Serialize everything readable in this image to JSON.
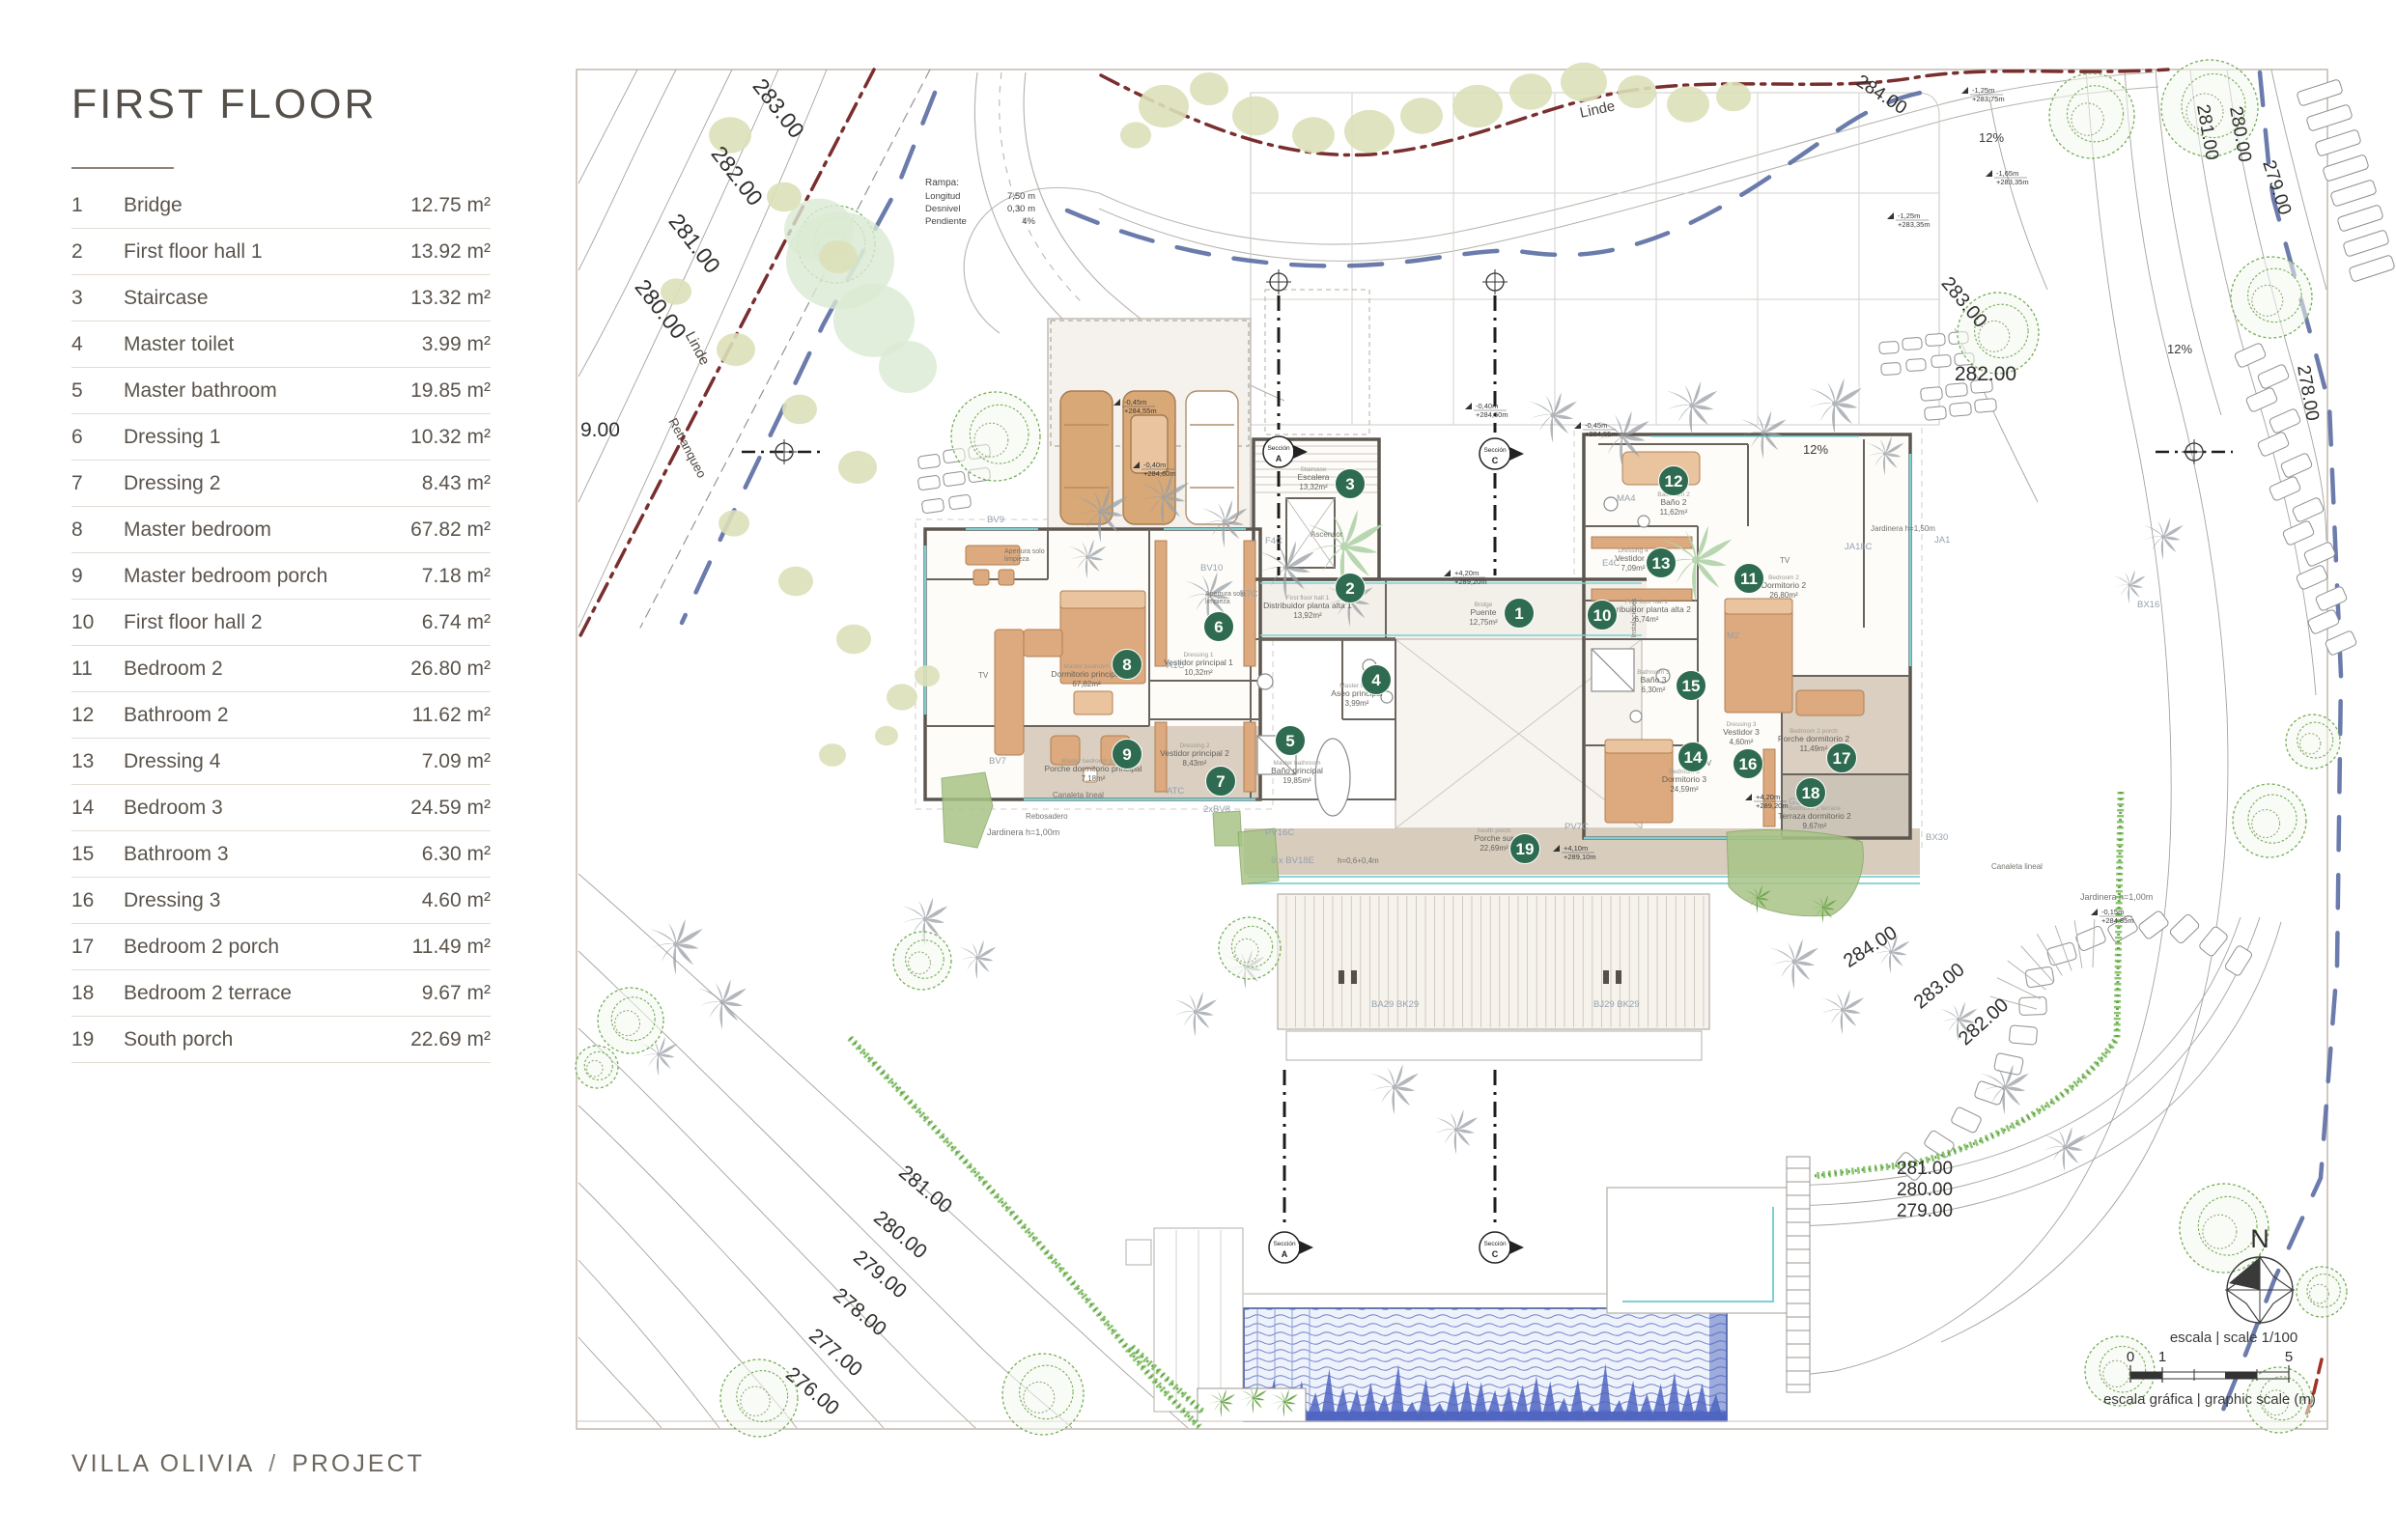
{
  "page": {
    "title": "FIRST FLOOR",
    "footer": {
      "project_name": "VILLA OLIVIA",
      "separator": "/",
      "project_label": "PROJECT"
    }
  },
  "legend": {
    "rows": [
      {
        "num": "1",
        "name": "Bridge",
        "area": "12.75 m²"
      },
      {
        "num": "2",
        "name": "First floor hall 1",
        "area": "13.92 m²"
      },
      {
        "num": "3",
        "name": "Staircase",
        "area": "13.32 m²"
      },
      {
        "num": "4",
        "name": "Master toilet",
        "area": "3.99 m²"
      },
      {
        "num": "5",
        "name": "Master bathroom",
        "area": "19.85 m²"
      },
      {
        "num": "6",
        "name": "Dressing 1",
        "area": "10.32 m²"
      },
      {
        "num": "7",
        "name": "Dressing 2",
        "area": "8.43 m²"
      },
      {
        "num": "8",
        "name": "Master bedroom",
        "area": "67.82 m²"
      },
      {
        "num": "9",
        "name": "Master bedroom porch",
        "area": "7.18 m²"
      },
      {
        "num": "10",
        "name": "First floor hall 2",
        "area": "6.74 m²"
      },
      {
        "num": "11",
        "name": "Bedroom 2",
        "area": "26.80 m²"
      },
      {
        "num": "12",
        "name": "Bathroom 2",
        "area": "11.62 m²"
      },
      {
        "num": "13",
        "name": "Dressing 4",
        "area": "7.09 m²"
      },
      {
        "num": "14",
        "name": "Bedroom 3",
        "area": "24.59 m²"
      },
      {
        "num": "15",
        "name": "Bathroom 3",
        "area": "6.30 m²"
      },
      {
        "num": "16",
        "name": "Dressing 3",
        "area": "4.60 m²"
      },
      {
        "num": "17",
        "name": "Bedroom 2 porch",
        "area": "11.49 m²"
      },
      {
        "num": "18",
        "name": "Bedroom 2 terrace",
        "area": "9.67 m²"
      },
      {
        "num": "19",
        "name": "South porch",
        "area": "22.69 m²"
      }
    ]
  },
  "plan": {
    "colors": {
      "badge": "#2e6b50",
      "boundary": "#7a2e2e",
      "setback_blue": "#5a6da3",
      "glass": "#7cd0d4",
      "wall": "#5c564f",
      "furniture": "#dcaa7e",
      "pool": "#4e64c1"
    },
    "ramp_note": {
      "title": "Rampa:",
      "rows": [
        [
          "Longitud",
          "7,50 m"
        ],
        [
          "Desnivel",
          "0,30 m"
        ],
        [
          "Pendiente",
          "4%"
        ]
      ]
    },
    "boundary_labels": [
      [
        "Linde",
        1655,
        118,
        -12,
        15
      ],
      [
        "Linde",
        718,
        363,
        62,
        15
      ],
      [
        "Retranqueo",
        708,
        466,
        62,
        13
      ]
    ],
    "contour_labels": [
      [
        "283.00",
        800,
        117,
        52,
        23
      ],
      [
        "282.00",
        757,
        187,
        52,
        23
      ],
      [
        "281.00",
        713,
        257,
        52,
        23
      ],
      [
        "280.00",
        678,
        325,
        52,
        23
      ],
      [
        "9.00",
        601,
        452,
        0,
        21
      ],
      [
        "281.00",
        954,
        1237,
        40,
        21
      ],
      [
        "280.00",
        928,
        1284,
        40,
        21
      ],
      [
        "279.00",
        907,
        1325,
        40,
        21
      ],
      [
        "278.00",
        886,
        1364,
        40,
        21
      ],
      [
        "277.00",
        861,
        1406,
        40,
        21
      ],
      [
        "276.00",
        837,
        1446,
        40,
        21
      ],
      [
        "284.00",
        1945,
        103,
        33,
        19
      ],
      [
        "281.00",
        2280,
        138,
        80,
        19
      ],
      [
        "280.00",
        2314,
        140,
        80,
        19
      ],
      [
        "279.00",
        2352,
        196,
        72,
        19
      ],
      [
        "278.00",
        2384,
        408,
        80,
        19
      ],
      [
        "283.00",
        2029,
        317,
        50,
        20
      ],
      [
        "282.00",
        2056,
        394,
        0,
        21
      ],
      [
        "284.00",
        1940,
        986,
        -33,
        20
      ],
      [
        "283.00",
        2012,
        1026,
        -40,
        20
      ],
      [
        "282.00",
        2058,
        1063,
        -42,
        20
      ],
      [
        "281.00",
        1993,
        1216,
        0,
        19
      ],
      [
        "280.00",
        1993,
        1238,
        0,
        19
      ],
      [
        "279.00",
        1993,
        1260,
        0,
        19
      ]
    ],
    "slope_labels": [
      [
        "12%",
        2062,
        147
      ],
      [
        "12%",
        2257,
        366
      ],
      [
        "12%",
        1880,
        470
      ]
    ],
    "level_markers": [
      [
        "-0,45m",
        "+284,55m",
        1160,
        420
      ],
      [
        "-0,40m",
        "+284,50m",
        1524,
        424
      ],
      [
        "-0,45m",
        "+284,55m",
        1637,
        444
      ],
      [
        "-0,40m",
        "+284,60m",
        1180,
        485
      ],
      [
        "+4,20m",
        "+289,20m",
        1502,
        597
      ],
      [
        "+4,10m",
        "+289,10m",
        1615,
        882
      ],
      [
        "+4,20m",
        "+289,20m",
        1814,
        829
      ],
      [
        "-1,25m",
        "+283,75m",
        2038,
        97
      ],
      [
        "-1,65m",
        "+283,35m",
        2063,
        183
      ],
      [
        "-1,25m",
        "+283,35m",
        1961,
        227
      ],
      [
        "-0,15m",
        "+284,85m",
        2172,
        948
      ]
    ],
    "badges": [
      [
        1,
        1573,
        635
      ],
      [
        2,
        1398,
        609
      ],
      [
        3,
        1398,
        501
      ],
      [
        4,
        1425,
        704
      ],
      [
        5,
        1336,
        767
      ],
      [
        6,
        1262,
        649
      ],
      [
        7,
        1264,
        809
      ],
      [
        8,
        1167,
        688
      ],
      [
        9,
        1167,
        781
      ],
      [
        10,
        1659,
        637
      ],
      [
        11,
        1811,
        599
      ],
      [
        12,
        1733,
        498
      ],
      [
        13,
        1720,
        583
      ],
      [
        14,
        1753,
        784
      ],
      [
        15,
        1751,
        710
      ],
      [
        16,
        1810,
        791
      ],
      [
        17,
        1907,
        785
      ],
      [
        18,
        1875,
        821
      ],
      [
        19,
        1579,
        879
      ]
    ],
    "room_labels": [
      [
        "Bridge",
        "Puente",
        "12,75m²",
        1536,
        637
      ],
      [
        "First floor hall 1",
        "Distribuidor planta alta 1",
        "13,92m²",
        1354,
        630
      ],
      [
        "Staircase",
        "Escalera",
        "13,32m²",
        1360,
        497
      ],
      [
        "Master toilet",
        "Aseo principal",
        "3,99m²",
        1405,
        721
      ],
      [
        "Master bathroom",
        "Baño principal",
        "19,85m²",
        1343,
        801
      ],
      [
        "Dressing 1",
        "Vestidor principal 1",
        "10,32m²",
        1241,
        689
      ],
      [
        "Dressing 2",
        "Vestidor principal 2",
        "8,43m²",
        1237,
        783
      ],
      [
        "Master bedroom",
        "Dormitorio principal",
        "67,82m²",
        1125,
        701
      ],
      [
        "Master bedroom porch",
        "Porche dormitorio principal",
        "7,18m²",
        1132,
        799
      ],
      [
        "First floor hall 2",
        "Distribuidor planta alta 2",
        "6,74m²",
        1705,
        634
      ],
      [
        "Bedroom 2",
        "Dormitorio 2",
        "26,80m²",
        1847,
        609
      ],
      [
        "Bathroom 2",
        "Baño 2",
        "11,62m²",
        1733,
        523
      ],
      [
        "Dressing 4",
        "Vestidor 2",
        "7,09m²",
        1691,
        581
      ],
      [
        "Bedroom 3",
        "Dormitorio 3",
        "24,59m²",
        1744,
        810
      ],
      [
        "Bathroom 3",
        "Baño 3",
        "6,30m²",
        1712,
        707
      ],
      [
        "Dressing 3",
        "Vestidor 3",
        "4,60m²",
        1803,
        761
      ],
      [
        "Bedroom 2 porch",
        "Porche dormitorio 2",
        "11,49m²",
        1878,
        768
      ],
      [
        "Bedroom 2 terrace",
        "Terraza dormitorio 2",
        "9,67m²",
        1879,
        848
      ],
      [
        "South porch",
        "Porche sur",
        "22,69m²",
        1547,
        871
      ]
    ],
    "component_codes": [
      [
        "BV9",
        1022,
        541
      ],
      [
        "BV10",
        1243,
        591
      ],
      [
        "BV7",
        1024,
        791
      ],
      [
        "2xBV8",
        1246,
        841
      ],
      [
        "F4C",
        1310,
        563
      ],
      [
        "E7C",
        1284,
        618
      ],
      [
        "A1C",
        1208,
        692
      ],
      [
        "ATC",
        1208,
        822
      ],
      [
        "E4C",
        1659,
        586
      ],
      [
        "MA4",
        1674,
        519
      ],
      [
        "PV16C",
        1310,
        865
      ],
      [
        "PV7C",
        1620,
        859
      ],
      [
        "G3",
        1852,
        833
      ],
      [
        "M2",
        1788,
        661
      ],
      [
        "JA1",
        2003,
        562
      ],
      [
        "JA18C",
        1910,
        569
      ],
      [
        "BX16",
        2213,
        629
      ],
      [
        "BX30",
        1994,
        870
      ],
      [
        "BA29  BK29",
        1420,
        1043
      ],
      [
        "BJ29  BK29",
        1650,
        1043
      ],
      [
        "9 x BV18E",
        1316,
        894
      ]
    ],
    "misc_labels": [
      [
        "Apertura solo",
        1040,
        573,
        7
      ],
      [
        "limpieza",
        1040,
        581,
        7
      ],
      [
        "Apertura solo",
        1248,
        617,
        7
      ],
      [
        "limpieza",
        1248,
        625,
        7
      ],
      [
        "Ascensor",
        1357,
        556,
        8
      ],
      [
        "TV",
        1013,
        702,
        8
      ],
      [
        "TV",
        1843,
        583,
        8
      ],
      [
        "TV",
        1762,
        793,
        8
      ],
      [
        "Jardinera h=1,00m",
        1022,
        865,
        9
      ],
      [
        "Jardinera h=1,00m",
        2154,
        932,
        9
      ],
      [
        "Jardinera h=1,50m",
        1937,
        550,
        8
      ],
      [
        "Canaleta lineal",
        1090,
        826,
        8
      ],
      [
        "Canaleta lineal",
        2062,
        900,
        8
      ],
      [
        "Rebosadero",
        1062,
        848,
        8
      ],
      [
        "h=0,6+0,4m",
        1385,
        894,
        8
      ]
    ],
    "vertical_labels": [
      [
        "Instalaciones",
        1694,
        640,
        7
      ]
    ],
    "section_markers": [
      [
        "Sección",
        "A",
        1324,
        468
      ],
      [
        "Sección",
        "C",
        1548,
        470
      ],
      [
        "Sección",
        "A",
        1330,
        1292
      ],
      [
        "Sección",
        "C",
        1548,
        1292
      ]
    ],
    "north_label": "N",
    "scale_bar": {
      "title": "escala | scale 1/100",
      "numbers": [
        "0",
        "1",
        "5"
      ],
      "caption": "escala gráfica | graphic scale (m)"
    }
  }
}
